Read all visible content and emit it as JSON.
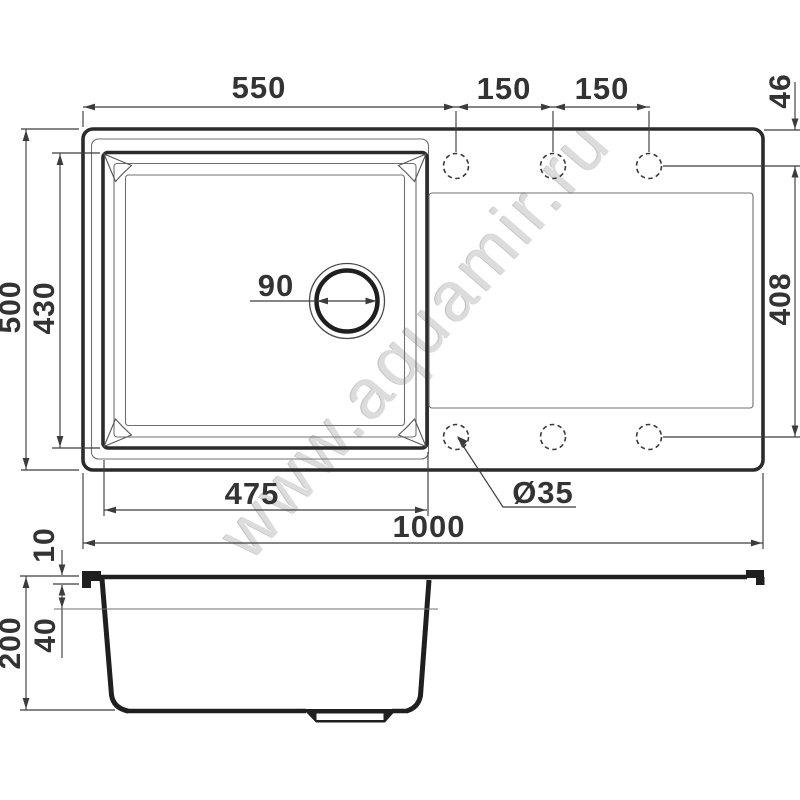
{
  "watermark": "www.aquamir.ru",
  "colors": {
    "line_thick": "#2b2b2b",
    "line_thin": "#707070",
    "line_dim": "#3c3c3c",
    "text": "#333333",
    "watermark": "#dcdcdc",
    "background": "#ffffff"
  },
  "views": {
    "top_view": "sink top view",
    "side_view": "sink section view"
  },
  "dims": {
    "bowl_outer_width": "550",
    "hole_pitch_left": "150",
    "hole_pitch_right": "150",
    "hole_edge_offset": "46",
    "overall_depth": "500",
    "bowl_inner_depth": "430",
    "drain_diameter": "90",
    "holes_span": "408",
    "bowl_inner_width": "475",
    "hole_diameter": "Ø35",
    "overall_width": "1000",
    "rim_thickness": "10",
    "drainer_depth": "40",
    "bowl_height": "200"
  }
}
